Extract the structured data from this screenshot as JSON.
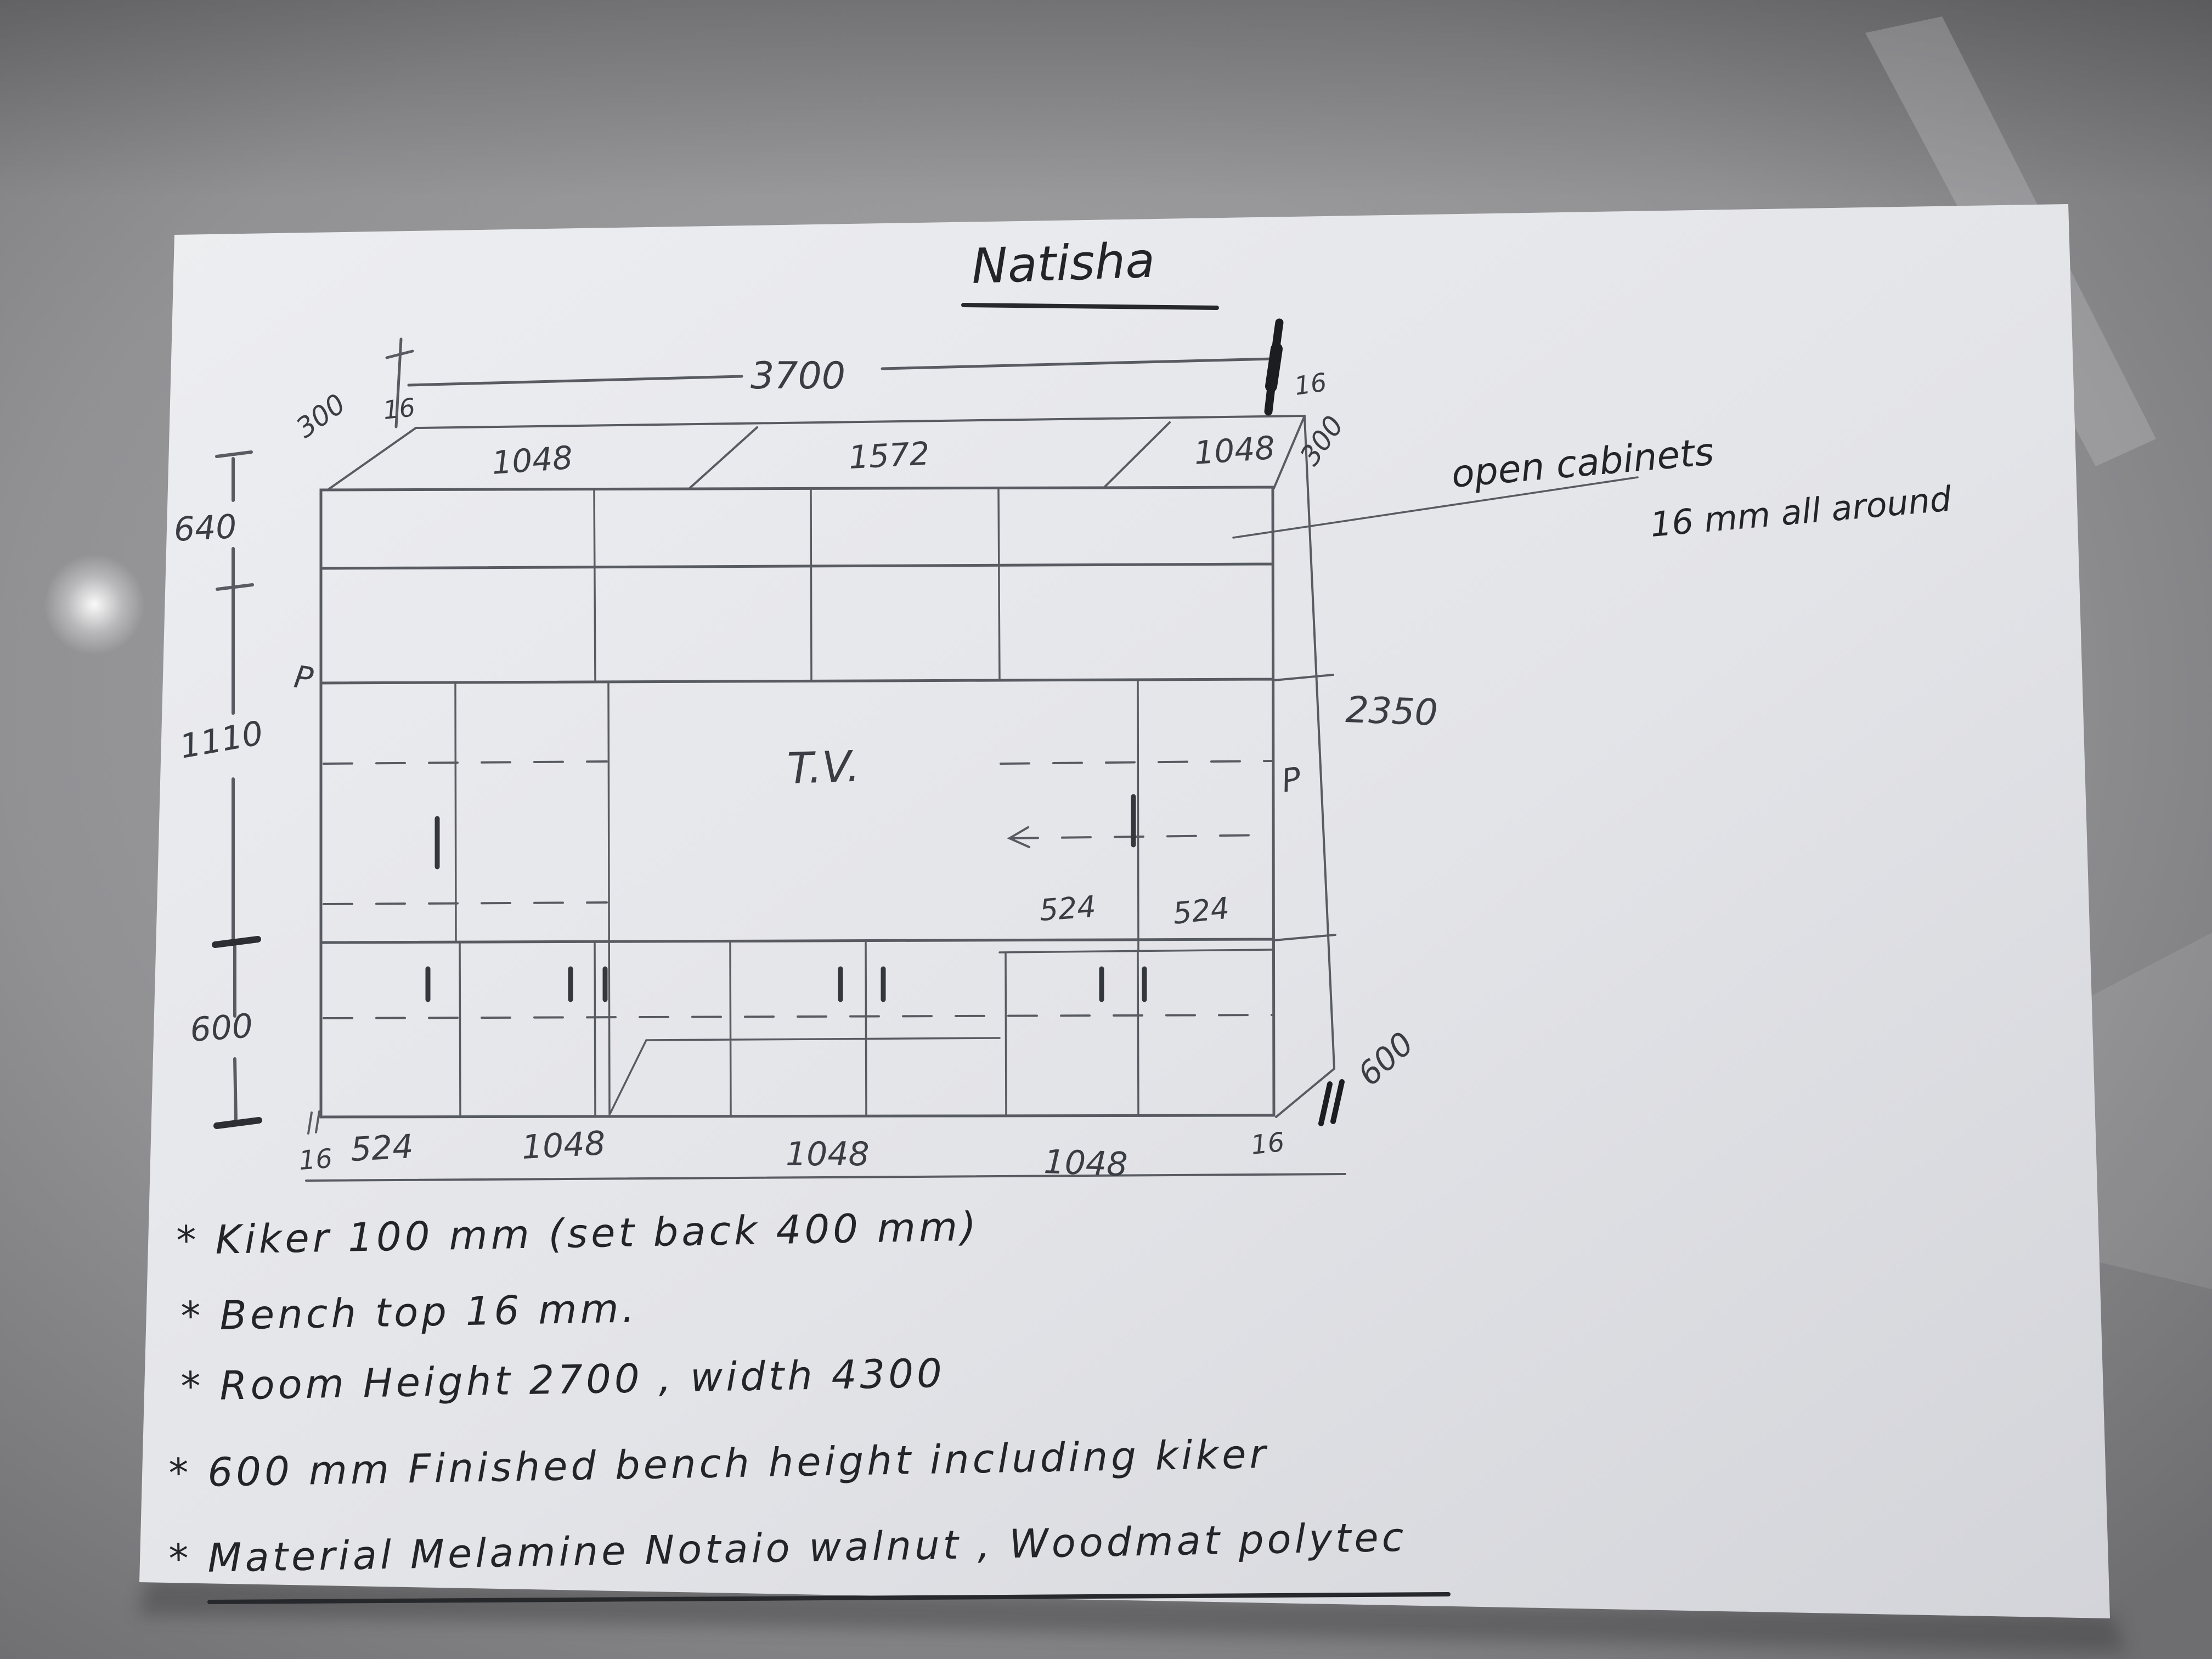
{
  "title": {
    "text": "Natisha"
  },
  "annotation": {
    "line1": "open cabinets",
    "line2": "16 mm all around"
  },
  "top_dims": {
    "overall": "3700",
    "edge_left": "16",
    "edge_right": "16",
    "depth_left": "300",
    "depth_right": "300",
    "seg1": "1048",
    "seg2": "1572",
    "seg3": "1048"
  },
  "left_dims": {
    "top": "640",
    "middle": "1110",
    "bottom": "600"
  },
  "right_dims": {
    "height": "2350",
    "depth_bottom": "600",
    "pull": "P"
  },
  "interior": {
    "tv": "T.V.",
    "shelf_left": "524",
    "shelf_right": "524",
    "pull_left": "P"
  },
  "bottom_dims": {
    "edge_left": "16",
    "seg1": "524",
    "seg2": "1048",
    "seg3": "1048",
    "seg4": "1048",
    "edge_right": "16"
  },
  "notes": {
    "line1": "* Kiker 100 mm (set back 400 mm)",
    "line2": "* Bench top 16 mm.",
    "line3": "* Room Height 2700 , width 4300",
    "line4": "* 600 mm Finished bench height including kiker",
    "line5": "* Material Melamine Notaio walnut , Woodmat polytec"
  }
}
